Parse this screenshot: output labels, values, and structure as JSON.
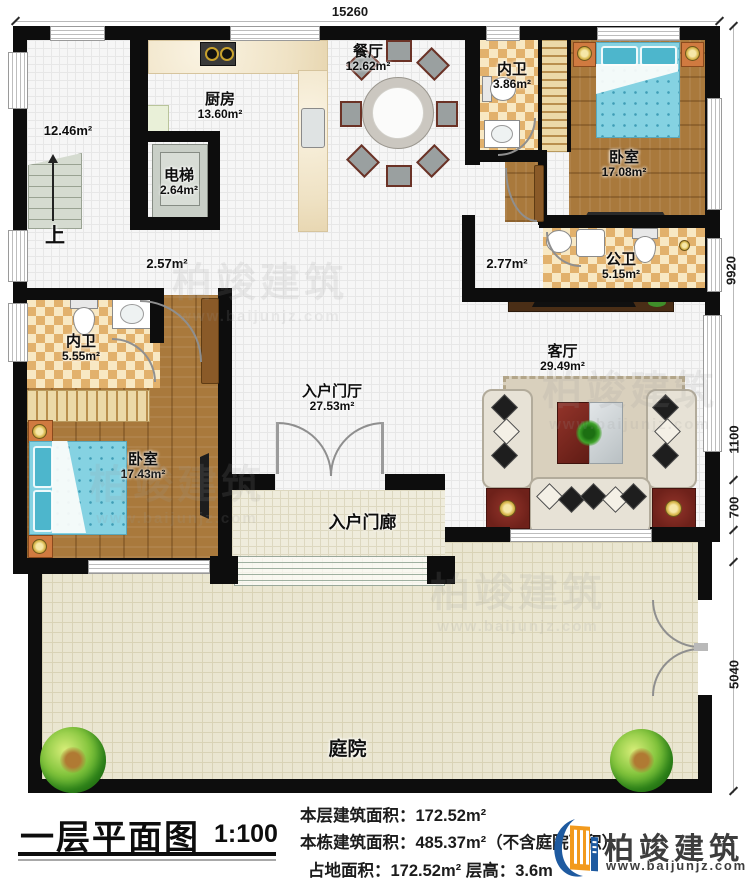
{
  "dimensions": {
    "top": "15260",
    "right_1": "9920",
    "right_2": "1100",
    "right_3": "700",
    "right_4": "5040"
  },
  "rooms": {
    "stair_hall_area": "12.46m²",
    "stairs_up": "上",
    "elevator": {
      "name": "电梯",
      "area": "2.64m²"
    },
    "kitchen": {
      "name": "厨房",
      "area": "13.60m²"
    },
    "dining": {
      "name": "餐厅",
      "area": "12.62m²"
    },
    "ensuite_top": {
      "name": "内卫",
      "area": "3.86m²"
    },
    "bedroom_top": {
      "name": "卧室",
      "area": "17.08m²"
    },
    "public_bath": {
      "name": "公卫",
      "area": "5.15m²"
    },
    "hall_left_area": "2.57m²",
    "hall_right_area": "2.77m²",
    "ensuite_left": {
      "name": "内卫",
      "area": "5.55m²"
    },
    "bedroom_left": {
      "name": "卧室",
      "area": "17.43m²"
    },
    "foyer": {
      "name": "入户门厅",
      "area": "27.53m²"
    },
    "living": {
      "name": "客厅",
      "area": "29.49m²"
    },
    "porch": {
      "name": "入户门廊"
    },
    "courtyard": {
      "name": "庭院"
    }
  },
  "titleblock": {
    "title": "一层平面图",
    "scale": "1:100",
    "area_lines": [
      "本层建筑面积：172.52m²",
      "本栋建筑面积：485.37m²（不含庭院面积）",
      "占地面积：172.52m²  层高：3.6m"
    ]
  },
  "brand": {
    "name": "柏竣建筑",
    "url": "www.baijunjz.com"
  },
  "watermark": {
    "name": "柏竣建筑",
    "url": "www.baijunjz.com"
  }
}
